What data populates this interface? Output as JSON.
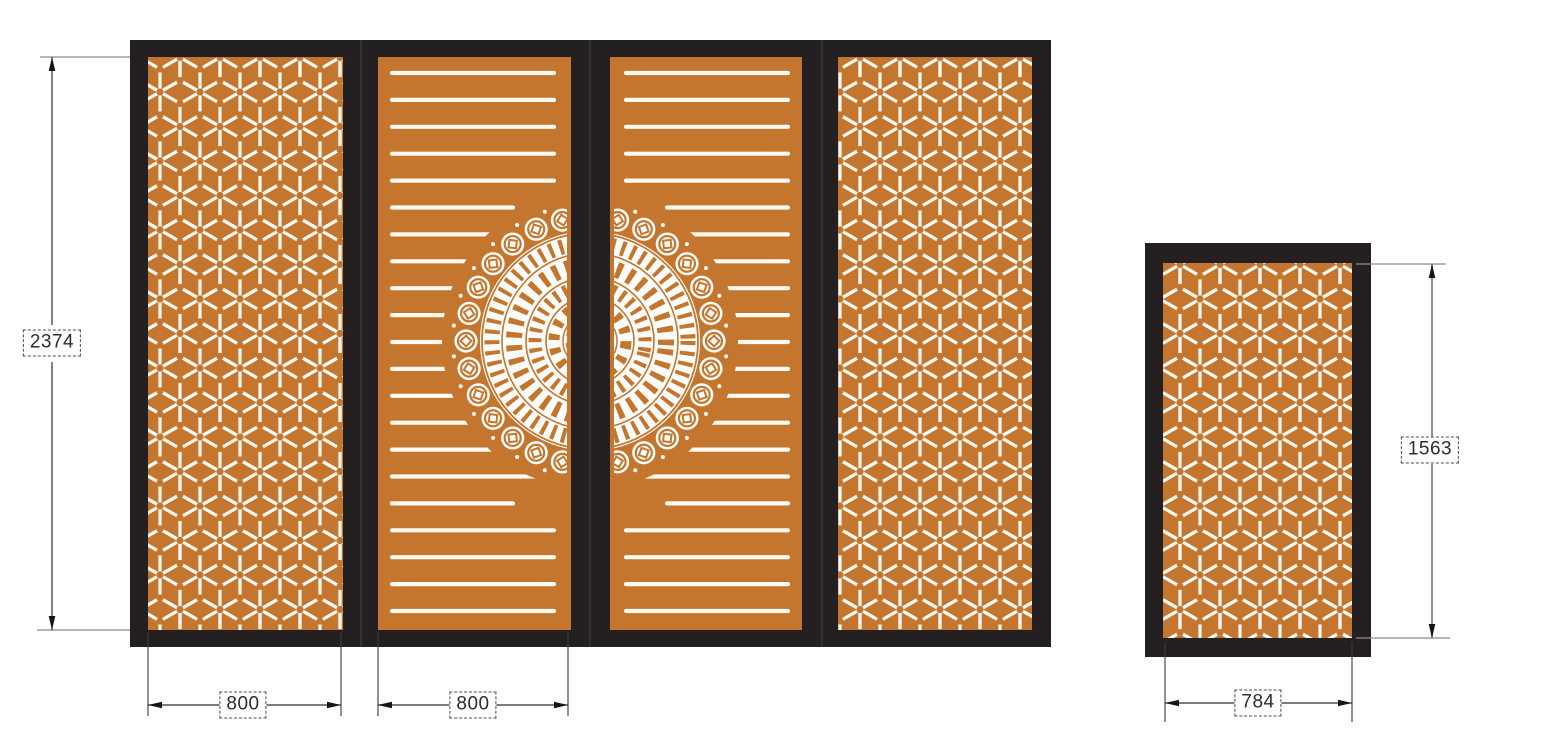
{
  "dimensions": {
    "main_height": "2374",
    "panel1_width": "800",
    "panel2_width": "800",
    "side_height": "1563",
    "side_width": "784"
  },
  "colors": {
    "panel_orange": "#C4762E",
    "frame_black": "#242021",
    "cutout_white": "#FCF9F2",
    "dimension_line_dark": "#2E2E2E",
    "dimension_line_gray": "#8F8F8F"
  },
  "patterns": {
    "panel1": "hex-cube-lattice",
    "panel2": "horizontal-slats-mandala-left-half",
    "panel3": "horizontal-slats-mandala-right-half",
    "panel4": "hex-cube-lattice",
    "side_panel": "hex-cube-lattice",
    "center_ornament": "chinese-coin-mandala"
  }
}
